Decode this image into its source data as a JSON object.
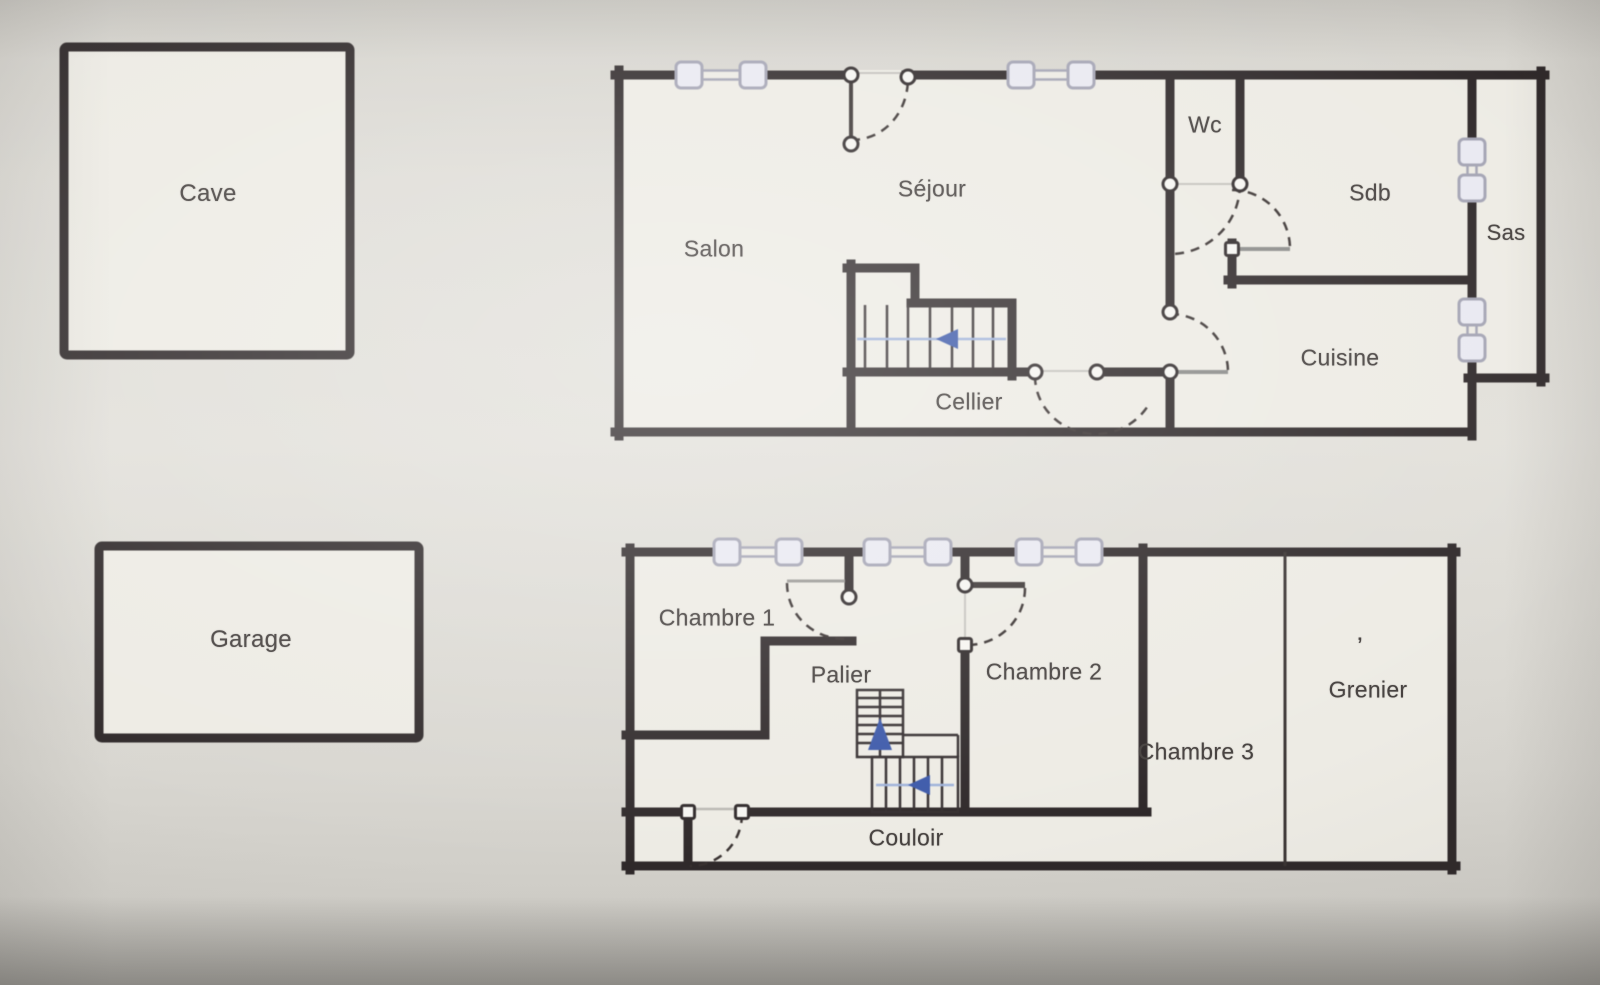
{
  "document": {
    "type": "floor-plan",
    "description": "Two-level French house floor plan photographed on a screen"
  },
  "colors": {
    "wall": "#2e2829",
    "paper": "#edebe4",
    "background": "#dad8d2",
    "window_fill": "#e9e9f1",
    "window_stroke": "#a3a3b3",
    "door_arc": "#37302f",
    "door_leaf_gray": "#9a9895",
    "stair_arrow_blue": "#3a57a8",
    "direction_line_blue": "#9db1d9",
    "label_text": "#45403e"
  },
  "annex": {
    "cave": "Cave",
    "garage": "Garage"
  },
  "ground_floor": {
    "salon": "Salon",
    "sejour": "Séjour",
    "wc": "Wc",
    "sdb": "Sdb",
    "sas": "Sas",
    "cuisine": "Cuisine",
    "cellier": "Cellier"
  },
  "upper_floor": {
    "chambre1": "Chambre 1",
    "palier": "Palier",
    "chambre2": "Chambre 2",
    "chambre3": "Chambre 3",
    "grenier": "Grenier",
    "couloir": "Couloir",
    "grenier_mark": "’"
  },
  "stairs": {
    "ground_floor_direction": "left",
    "upper_floor_up_direction": "up",
    "upper_floor_lower_flight_direction": "left"
  }
}
